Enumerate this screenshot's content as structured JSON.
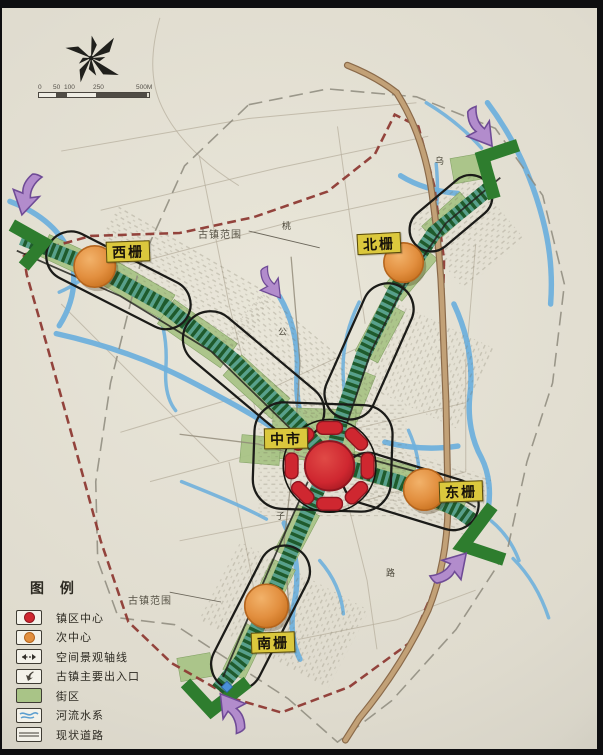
{
  "scale_bar": {
    "ticks": [
      "0",
      "50",
      "100",
      "250",
      "500M"
    ]
  },
  "legend": {
    "title": "图  例",
    "items": [
      {
        "label": "镇区中心"
      },
      {
        "label": "次中心"
      },
      {
        "label": "空间景观轴线"
      },
      {
        "label": "古镇主要出入口"
      },
      {
        "label": "街区"
      },
      {
        "label": "河流水系"
      },
      {
        "label": "现状道路"
      }
    ]
  },
  "districts": {
    "west": "西栅",
    "north": "北栅",
    "east": "东栅",
    "south": "南栅",
    "center": "中市"
  },
  "boundary_label": "古镇范围",
  "street_labels": {
    "a": "乌",
    "b": "桃",
    "c": "公",
    "d": "子",
    "e": "路"
  },
  "colors": {
    "accent_red": "#cf2730",
    "sub_center_orange": "#e28f3f",
    "axis_green": "#1e5b2d",
    "axis_teal": "#57a08c",
    "block_green": "#a9c487",
    "river_blue": "#6fb0dc",
    "boundary_red": "#8e3a34",
    "road_brown": "#c2a177",
    "entrance_purple": "#b28ccc",
    "label_yellow": "#dbc83d"
  }
}
